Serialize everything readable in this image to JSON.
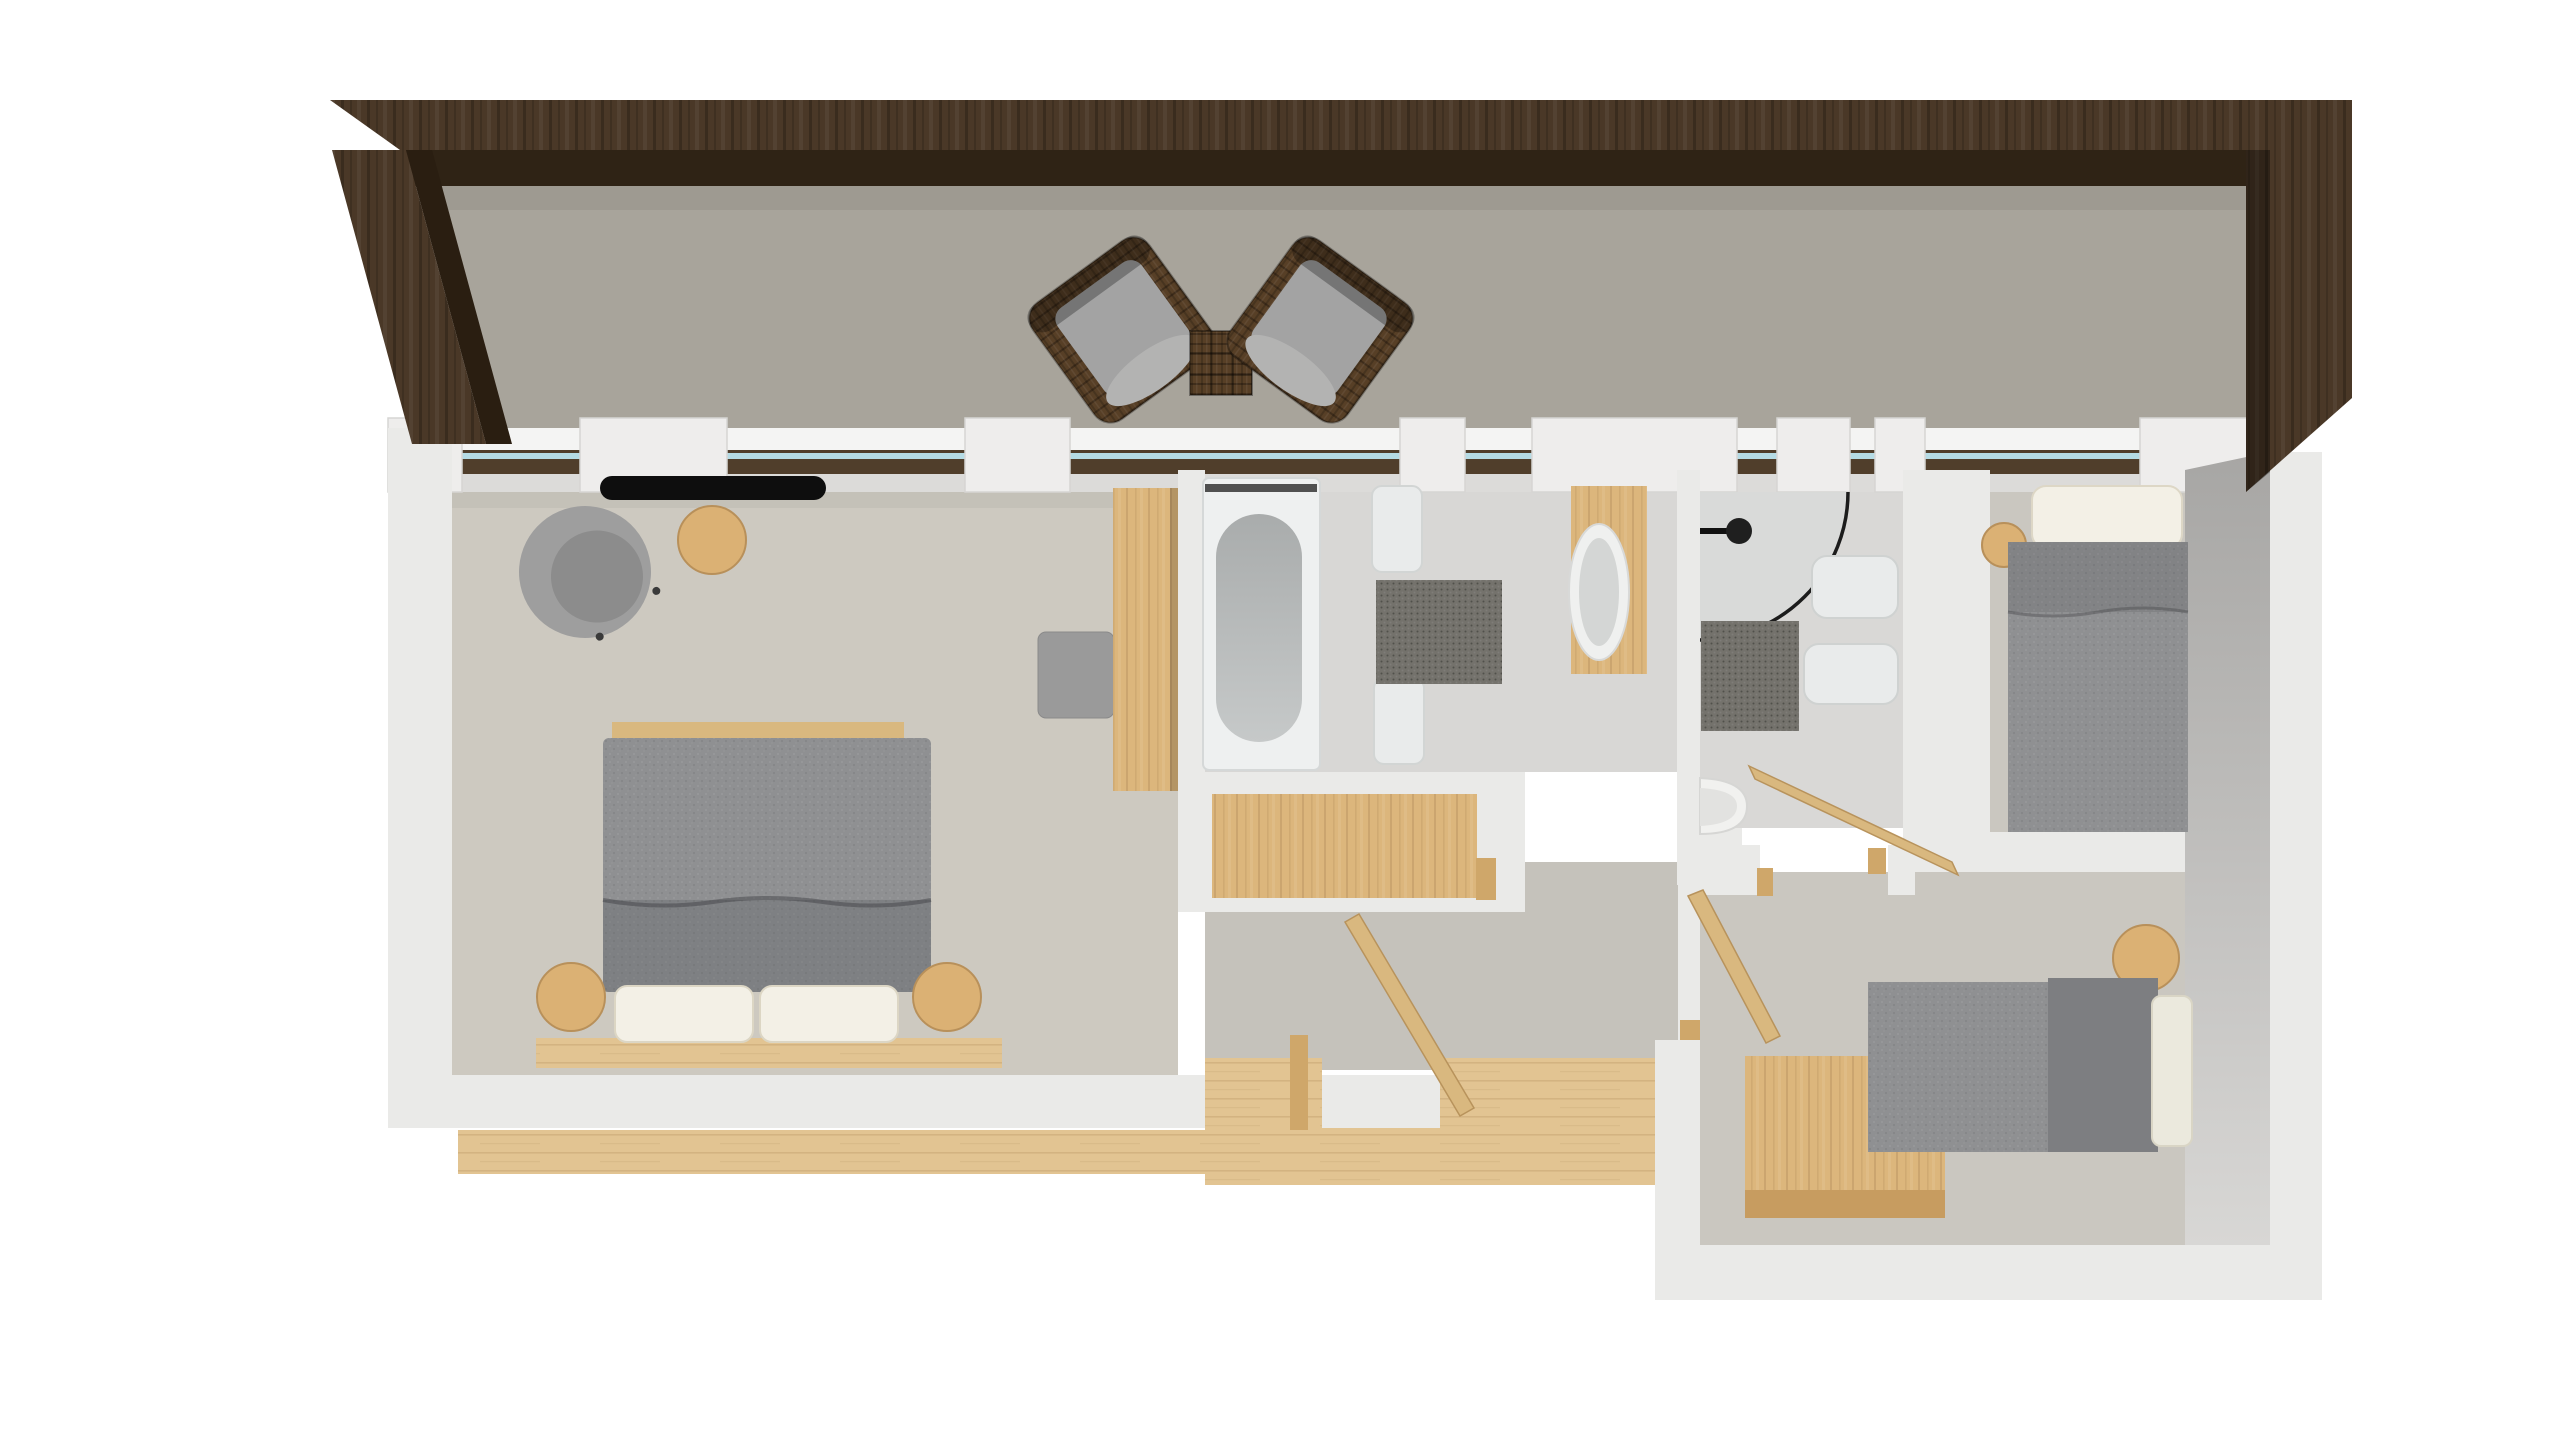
{
  "meta": {
    "title": "3D apartment floor plan - top-down render",
    "style": "architectural 3D top-down rendering, no visible text or UI chrome",
    "visible_text": "none"
  },
  "colors": {
    "background": "#ffffff",
    "beam_top": "#4a3827",
    "beam_shadow": "#2f2315",
    "beam_side": "#2a1e11",
    "terrace_floor": "#a8a49b",
    "wall_white": "#eaeae8",
    "wall_pier": "#eeedec",
    "wall_edge": "#d5d4d2",
    "window_sill": "#503e2b",
    "window_glass": "#b5dbe4",
    "window_outer_ledge": "#f4f4f3",
    "bedroom_floor": "#cdc9c0",
    "bathroom_floor": "#d8d7d5",
    "shower_floor": "#d9d8d6",
    "bedroom_right_floor": "#cac7c0",
    "hall_floor": "#c5c2bb",
    "wood_floor": "#e2c492",
    "door_wood": "#d9b87f",
    "jamb_wood": "#cfa76a",
    "furniture_wood": "#dbb174",
    "wardrobe_wood": "#d2a76c",
    "panel_wood": "#dcb67c",
    "desk_front": "#c79c60",
    "fabric_gray": "#8f9092",
    "fabric_dark": "#7d7e81",
    "cushion_gray": "#a3a3a3",
    "pillow_white": "#f3f0e6",
    "mattress_white": "#ebe9dd",
    "fixture_white": "#e9ebeb",
    "tub_shell": "#eef0f0",
    "tub_inner": "#b9bcbc",
    "basin_inner": "#d4d6d5",
    "mat_dark": "#74726c",
    "wicker_brown": "#573f26",
    "radiator_black": "#0e0e0e",
    "wall_inner_face_top": "#a7a6a4",
    "wall_inner_face_bottom": "#d8d7d5"
  },
  "architecture": {
    "pergola": "dark stained wood roof beam running along the top edge and wrapping down the right side, with one angled post at the top-left",
    "terrace": "open terrace strip between pergola beam and apartment top wall",
    "windows": "continuous glazing band along the top wall: white piers alternating with windows that have dark brown exterior sills and pale blue glass lines",
    "entry": "bottom-center opening with wooden threshold, wooden vestibule floor and exterior wooden deck strip",
    "open_doors_count": 3
  },
  "rooms": [
    {
      "id": "terrace",
      "name": "Terrace",
      "furniture": [
        "wicker armchair (left, angled)",
        "wicker armchair (right, angled)",
        "square wicker side table"
      ]
    },
    {
      "id": "master-bedroom",
      "name": "Master bedroom (left)",
      "furniture": [
        "double bed with gray duvet and folded blanket",
        "2 white pillows",
        "2 round wooden nightstands",
        "wooden base board",
        "gray swivel armchair",
        "round wooden side table",
        "black wall desk/radiator",
        "gray ottoman",
        "tall wooden wardrobe panel"
      ]
    },
    {
      "id": "bathroom",
      "name": "Bathroom (center, with tub)",
      "furniture": [
        "built-in bathtub",
        "2 white benches",
        "dark bath mat",
        "freestanding oval washbasin on wooden board",
        "wooden vanity cabinet in lower wall"
      ]
    },
    {
      "id": "shower-room",
      "name": "Shower room (center-right)",
      "furniture": [
        "corner shower with curved glass and black shower head",
        "2 white sanitary fixtures",
        "dark bath mat",
        "white corner toilet"
      ]
    },
    {
      "id": "bedroom-top-right",
      "name": "Bedroom (top right)",
      "furniture": [
        "single bed with gray duvet and white pillow",
        "round wooden nightstand"
      ]
    },
    {
      "id": "bedroom-bottom-right",
      "name": "Bedroom (bottom right)",
      "furniture": [
        "single bed with gray duvet, dark cushion and white mattress end",
        "round wooden nightstand",
        "wooden desk/cabinet"
      ]
    },
    {
      "id": "hallway",
      "name": "Hallway / entry vestibule",
      "furniture": [
        "open wooden entry door",
        "open wooden bedroom door",
        "open wooden shower-room door",
        "wooden door jambs"
      ]
    }
  ]
}
